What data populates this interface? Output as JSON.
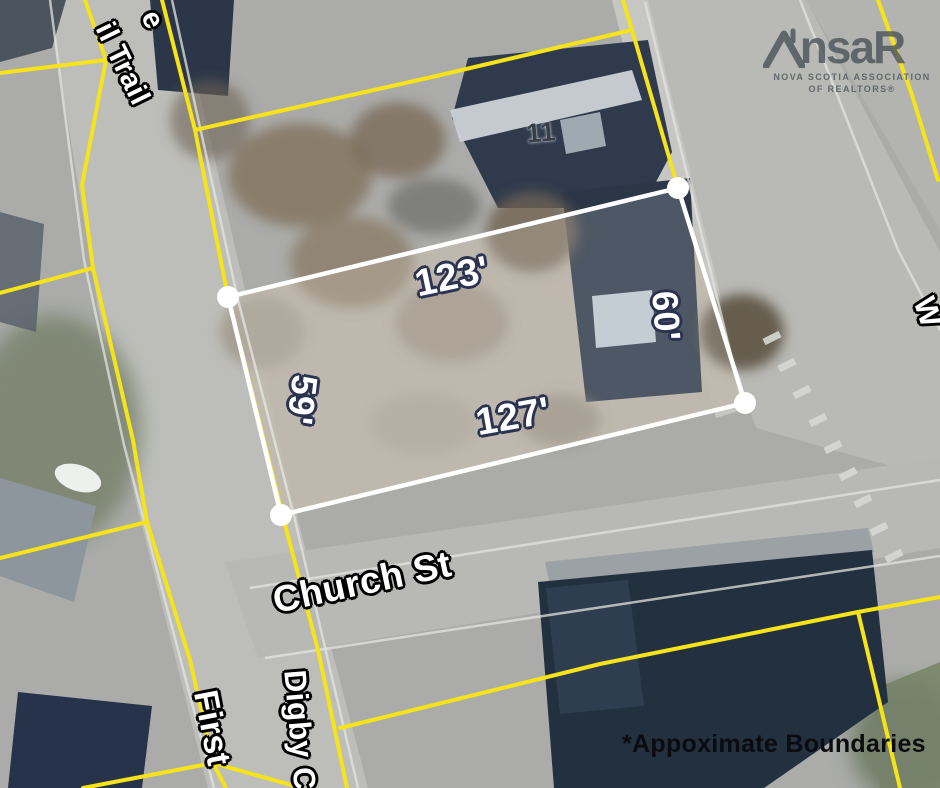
{
  "footnote": "*Appoximate Boundaries",
  "logo": {
    "mark_left": "ns",
    "mark_right": "aR",
    "roof_icon": "house-roof-icon",
    "tagline_line1": "NOVA SCOTIA ASSOCIATION",
    "tagline_line2": "OF REALTORS®"
  },
  "property": {
    "house_number": "11",
    "measurements": {
      "top": "123'",
      "right": "60'",
      "bottom": "127'",
      "left": "59'"
    }
  },
  "streets": {
    "church": "Church St",
    "digby": "Digby C",
    "first": "First",
    "rail_trail": "il Trail",
    "partial_top_left": "e",
    "partial_right": "W"
  },
  "colors": {
    "parcel_line": "#f6e31a",
    "boundary": "#ffffff",
    "measurement_outline": "#2b3350",
    "street_outline": "#000000",
    "footnote_text": "#0c0c10",
    "logo_gray": "#4e555b"
  }
}
